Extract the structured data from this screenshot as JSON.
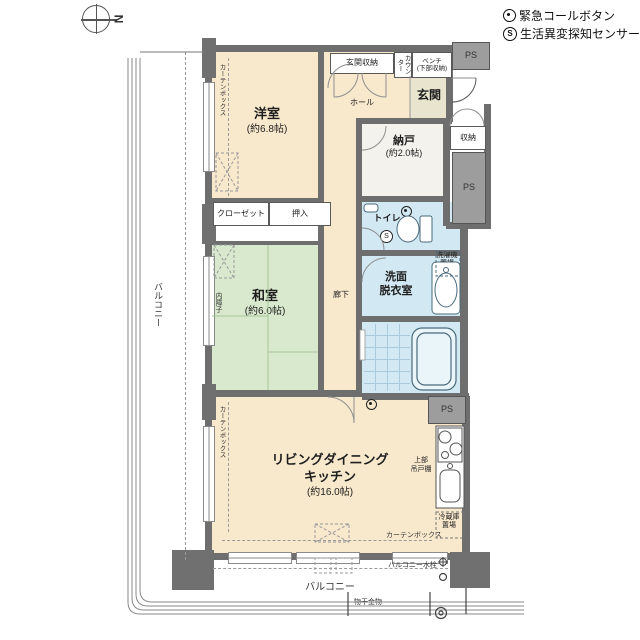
{
  "legend": {
    "call_button": "緊急コールボタン",
    "sensor": "生活異変探知センサー",
    "sensor_letter": "S"
  },
  "compass": {
    "north": "N"
  },
  "rooms": {
    "western": {
      "name": "洋室",
      "size": "(約6.8帖)"
    },
    "japanese": {
      "name": "和室",
      "size": "(約6.0帖)"
    },
    "ldk": {
      "line1": "リビングダイニング",
      "line2": "キッチン",
      "size": "(約16.0帖)"
    },
    "storeroom": {
      "name": "納戸",
      "size": "(約2.0帖)"
    },
    "entrance": {
      "name": "玄関"
    },
    "hall": {
      "name": "ホール"
    },
    "corridor": {
      "name": "廊下"
    },
    "toilet": {
      "name": "トイレ"
    },
    "washroom": {
      "line1": "洗面",
      "line2": "脱衣室"
    },
    "bathroom": {
      "name": "浴室"
    }
  },
  "fixtures": {
    "entrance_storage": "玄関収納",
    "counter": "カウンター",
    "bench_line1": "ベンチ",
    "bench_line2": "(下部収納)",
    "storage": "収納",
    "closet": "クローゼット",
    "oshiire": "押入",
    "washer_line1": "洗濯機",
    "washer_line2": "置場",
    "fridge_line1": "冷蔵庫",
    "fridge_line2": "置場",
    "cupboard_line1": "上部",
    "cupboard_line2": "吊戸棚",
    "curtain_box": "カーテンボックス",
    "inner_shoji": "内障子",
    "ps": "PS"
  },
  "balcony": {
    "label": "バルコニー",
    "faucet": "バルコニー水栓",
    "laundry_bar": "物干金物"
  },
  "colors": {
    "floor_beige": "#f8e8cc",
    "tatami_green": "#d8e9cd",
    "wet_blue": "#d2e8f2",
    "entrance_tile": "#e8e4ce",
    "wall_gray": "#6e6e6e",
    "ps_gray": "#9d9d9d"
  }
}
